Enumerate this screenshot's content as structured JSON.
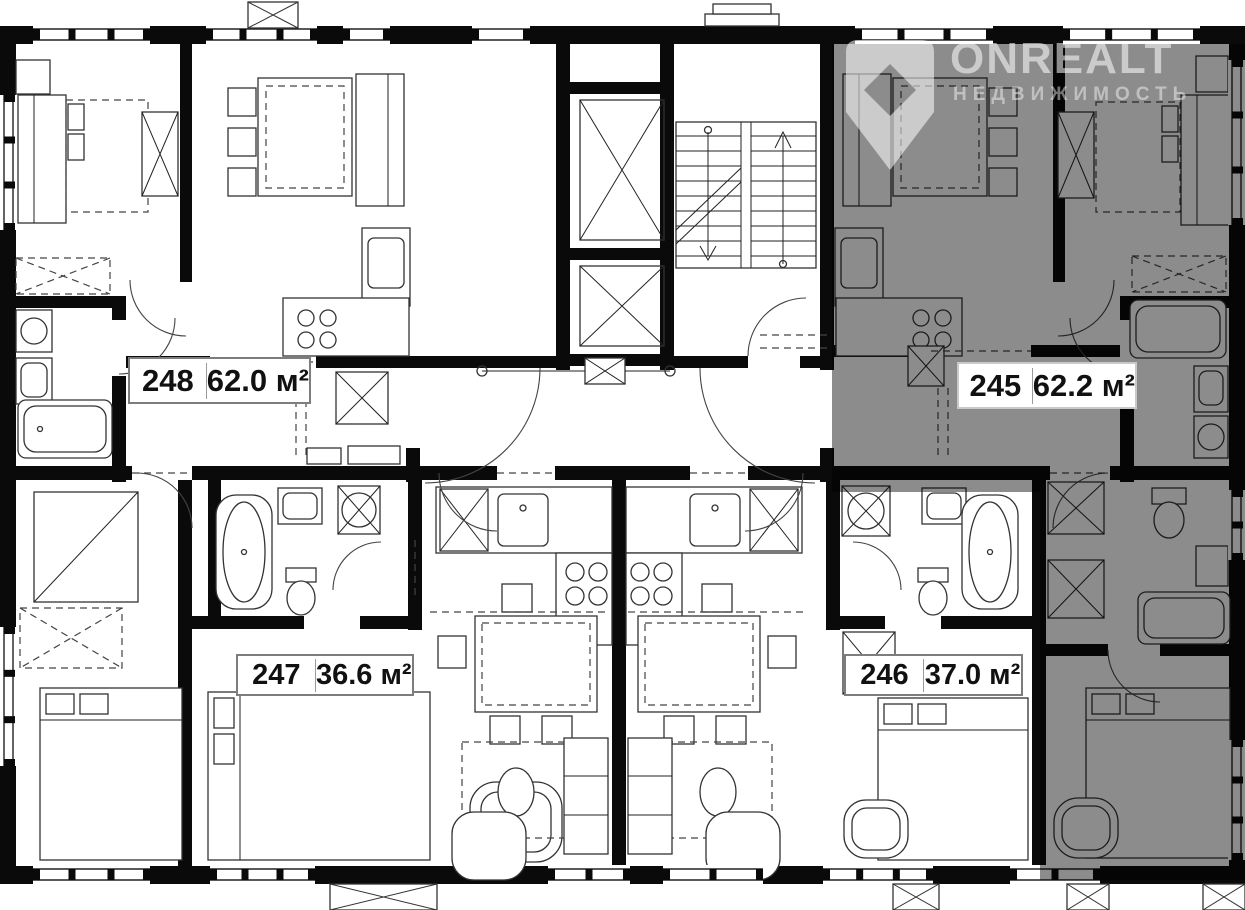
{
  "watermark": {
    "brand": "ONREALT",
    "subtitle": "НЕДВИЖИМОСТЬ"
  },
  "apartments": [
    {
      "number": "248",
      "area": "62.0 м²",
      "highlighted": false
    },
    {
      "number": "245",
      "area": "62.2 м²",
      "highlighted": true
    },
    {
      "number": "247",
      "area": "36.6 м²",
      "highlighted": false
    },
    {
      "number": "246",
      "area": "37.0 м²",
      "highlighted": false
    }
  ],
  "colors": {
    "paper": "#ffffff",
    "walls": "#0a0a0a",
    "furniture_line": "#333333",
    "highlight_overlay": "rgba(0,0,0,0.45)",
    "label_border": "#7d7d7d",
    "watermark": "rgba(255,255,255,0.55)"
  }
}
